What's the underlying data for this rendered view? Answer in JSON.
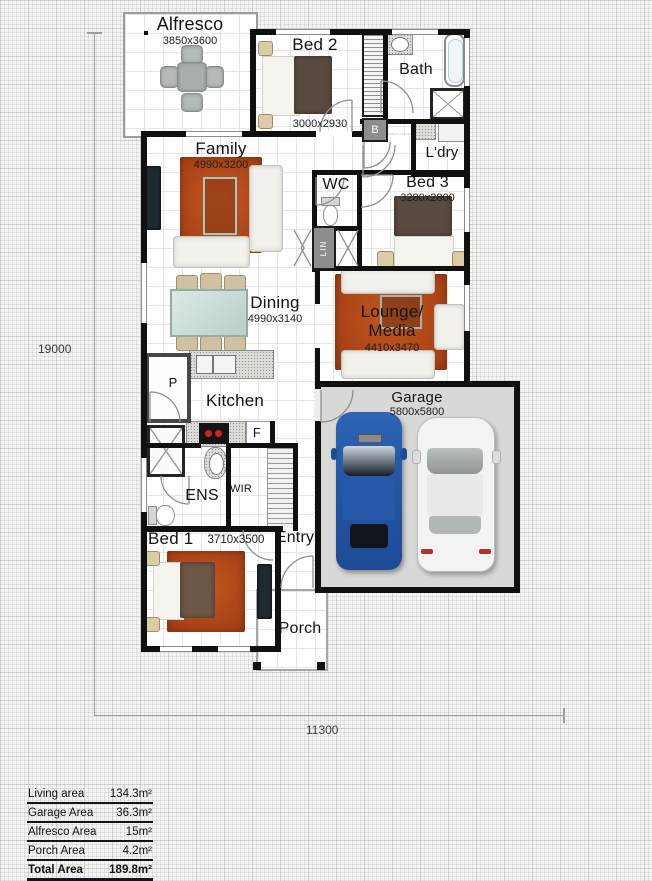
{
  "rooms": {
    "alfresco": {
      "label": "Alfresco",
      "dims": "3850x3600"
    },
    "bed2": {
      "label": "Bed 2",
      "dims": "3000x2930"
    },
    "bath": {
      "label": "Bath"
    },
    "ldry": {
      "label": "L'dry"
    },
    "family": {
      "label": "Family",
      "dims": "4990x3200"
    },
    "wc": {
      "label": "WC"
    },
    "bed3": {
      "label": "Bed 3",
      "dims": "3280x2800"
    },
    "dining": {
      "label": "Dining",
      "dims": "4990x3140"
    },
    "lounge": {
      "label1": "Lounge/",
      "label2": "Media",
      "dims": "4410x3470"
    },
    "kitchen": {
      "label": "Kitchen"
    },
    "garage": {
      "label": "Garage",
      "dims": "5800x5800"
    },
    "ens": {
      "label": "ENS"
    },
    "wir": {
      "label": "WIR"
    },
    "bed1": {
      "label": "Bed 1",
      "dims": "3710x3500"
    },
    "entry": {
      "label": "Entry"
    },
    "porch": {
      "label": "Porch"
    },
    "lin": {
      "label": "LIN"
    },
    "b_cupboard": {
      "label": "B"
    },
    "pantry": {
      "label": "P"
    },
    "fridge": {
      "label": "F"
    }
  },
  "site_dimensions": {
    "depth": "19000",
    "width": "11300"
  },
  "area_table": {
    "rows": [
      {
        "label": "Living area",
        "value": "134.3m²"
      },
      {
        "label": "Garage Area",
        "value": "36.3m²"
      },
      {
        "label": "Alfresco Area",
        "value": "15m²"
      },
      {
        "label": "Porch Area",
        "value": "4.2m²"
      },
      {
        "label": "Total Area",
        "value": "189.8m²"
      }
    ]
  },
  "colors": {
    "wall": "#101010",
    "rug": "#a63f15",
    "garage_floor": "#d8d8d6",
    "car_blue": "#2a5aa8",
    "car_white": "#f3f3f1"
  }
}
